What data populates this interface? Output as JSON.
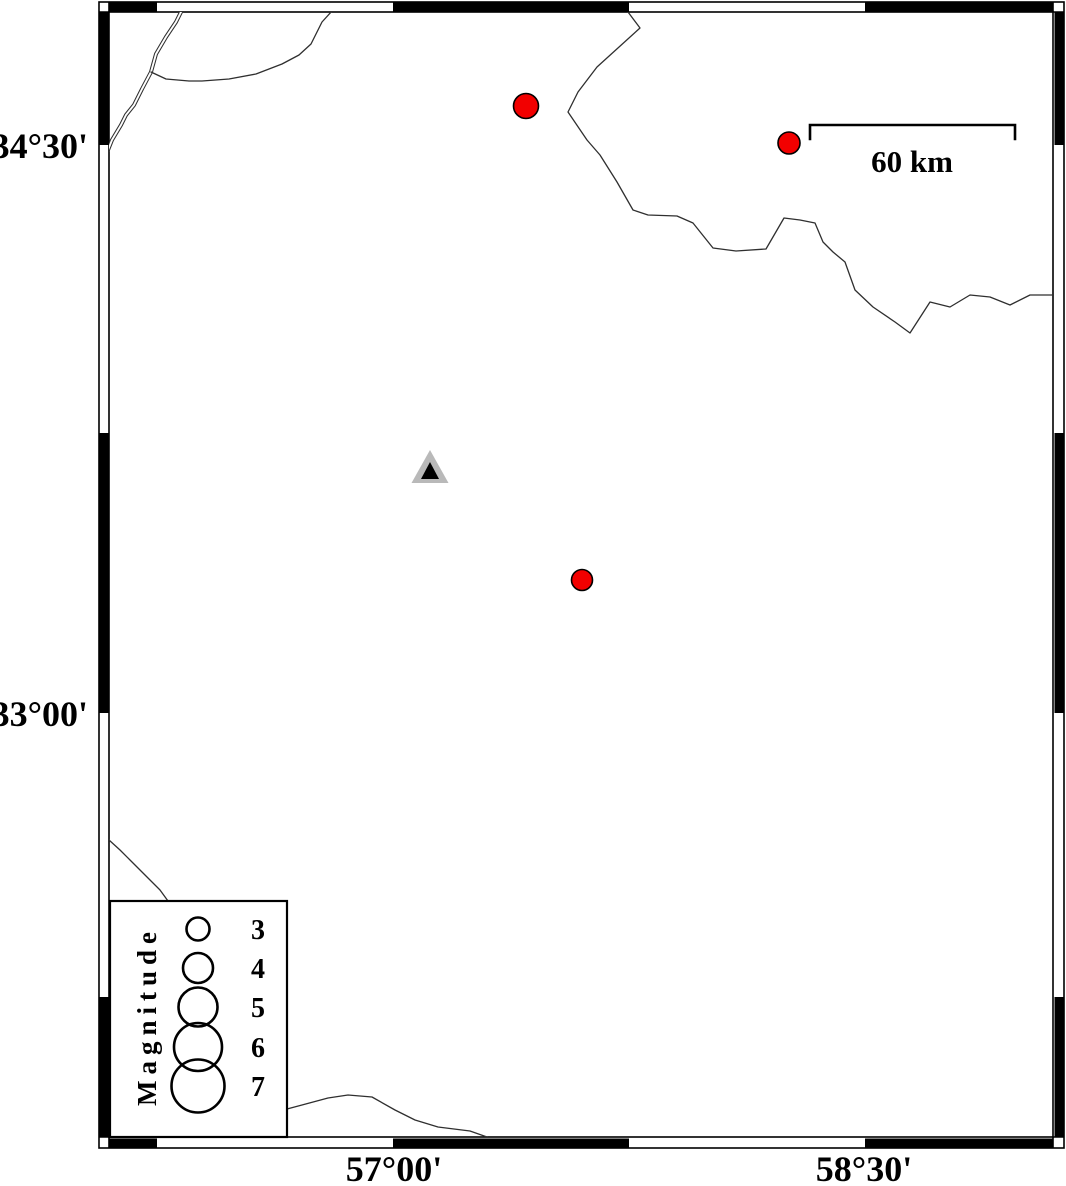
{
  "figure": {
    "type": "seismicity-map",
    "background": "#ffffff"
  },
  "frame": {
    "outer": {
      "x": 99,
      "y": 2,
      "w": 965,
      "h": 1146
    },
    "band": 10,
    "x_black_segments": [
      [
        109,
        157
      ],
      [
        393,
        629
      ],
      [
        865,
        1053
      ]
    ],
    "y_black_segments": [
      [
        12,
        145
      ],
      [
        433,
        713
      ],
      [
        997,
        1137
      ]
    ],
    "x_annotations": [
      {
        "label": "57°00'",
        "x": 394
      },
      {
        "label": "58°30'",
        "x": 864
      }
    ],
    "y_annotations": [
      {
        "label": "34°30'",
        "y": 145
      },
      {
        "label": "33°00'",
        "y": 713
      }
    ]
  },
  "scale_bar": {
    "label": "60 km",
    "x1": 810,
    "x2": 1015,
    "y": 125,
    "tick_drop": 14,
    "label_x": 912,
    "label_y": 172
  },
  "symbols": {
    "earthquake_color": "#f20000",
    "earthquakes": [
      {
        "x": 526,
        "y": 106,
        "r": 12.5
      },
      {
        "x": 789,
        "y": 143,
        "r": 11
      },
      {
        "x": 582,
        "y": 580,
        "r": 10.5
      }
    ],
    "station": {
      "x": 430,
      "y": 467,
      "outer_color": "#b9b9b9",
      "inner_color": "#000000"
    }
  },
  "legend": {
    "title": "Magnitude",
    "box": {
      "x": 110,
      "y": 901,
      "w": 177,
      "h": 236
    },
    "circle_cx": 198,
    "label_x": 258,
    "entries": [
      {
        "label": "3",
        "cy": 929,
        "r": 11.5
      },
      {
        "label": "4",
        "cy": 968,
        "r": 15
      },
      {
        "label": "5",
        "cy": 1007,
        "r": 19.5
      },
      {
        "label": "6",
        "cy": 1047,
        "r": 24
      },
      {
        "label": "7",
        "cy": 1086,
        "r": 26.5
      }
    ]
  }
}
